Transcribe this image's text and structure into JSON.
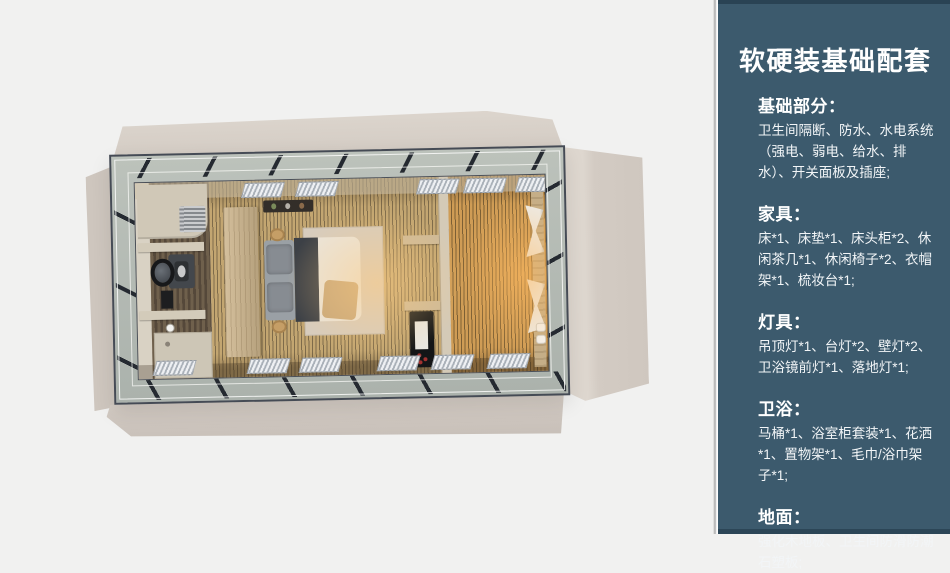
{
  "sidebar": {
    "title": "软硬装基础配套",
    "sections": [
      {
        "heading": "基础部分：",
        "body": "卫生间隔断、防水、水电系统（强电、弱电、给水、排水）、开关面板及插座;"
      },
      {
        "heading": "家具：",
        "body": "床*1、床垫*1、床头柜*2、休闲茶几*1、休闲椅子*2、衣帽架*1、梳妆台*1;"
      },
      {
        "heading": "灯具：",
        "body": "吊顶灯*1、台灯*2、壁灯*2、卫浴镜前灯*1、落地灯*1;"
      },
      {
        "heading": "卫浴：",
        "body": "马桶*1、浴室柜套装*1、花洒*1、置物架*1、毛巾/浴巾架子*1;"
      },
      {
        "heading": "地面：",
        "body": "强化木地板、卫生间防滑防潮石塑板;"
      }
    ]
  },
  "palette": {
    "page-bg": "#f1f1f0",
    "sidebar-bg": "#3c5a6d",
    "sidebar-text": "#ffffff",
    "frame-steel": "#454b55",
    "panel-beige": "#d3cbc3",
    "ring-glass": "#b3bab3",
    "floor-wood": "#c3a671",
    "floor-warm-glow": "#d99a4f",
    "bathroom-floor": "#6f604c",
    "wardrobe-wood": "#c6b192",
    "rug": "#d7ccbd",
    "duvet": "#eae4da",
    "blanket-dark": "#3c4046",
    "curtain": "#edece8"
  }
}
